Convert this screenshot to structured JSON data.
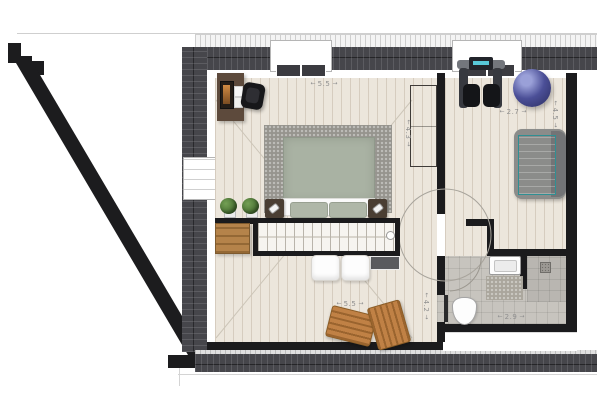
{
  "floorplan": {
    "title": "Attic floor plan",
    "arrows": {
      "left": "←",
      "right": "→"
    },
    "dimensions": {
      "bedroom_top": "5.5",
      "bedroom_side": "4.3",
      "bedroom_bottom": "5.5",
      "bedroom_bottom_side": "4.2",
      "gym_width": "2.7",
      "gym_side": "4.5",
      "bathroom_width": "2.9"
    },
    "colors": {
      "wall": "#1b1b1d",
      "roof": "#46464b",
      "floor": "#ece6dc",
      "tile": "#c7c4be",
      "rug": "#96948e",
      "bed": "#a9b2a3",
      "teal": "#5fd0cb",
      "ball": "#4b4f97",
      "wood": "#c08145",
      "dim_text": "#8f8f8f"
    },
    "furniture": [
      "desk",
      "office-chair",
      "double-bed",
      "nightstands",
      "plants",
      "storage-crate",
      "staircase",
      "floor-cushions",
      "lounge-chairs",
      "wardrobe",
      "exercise-machine",
      "gym-ball",
      "lounger",
      "sink",
      "bath-mat",
      "toilet",
      "shower"
    ]
  }
}
